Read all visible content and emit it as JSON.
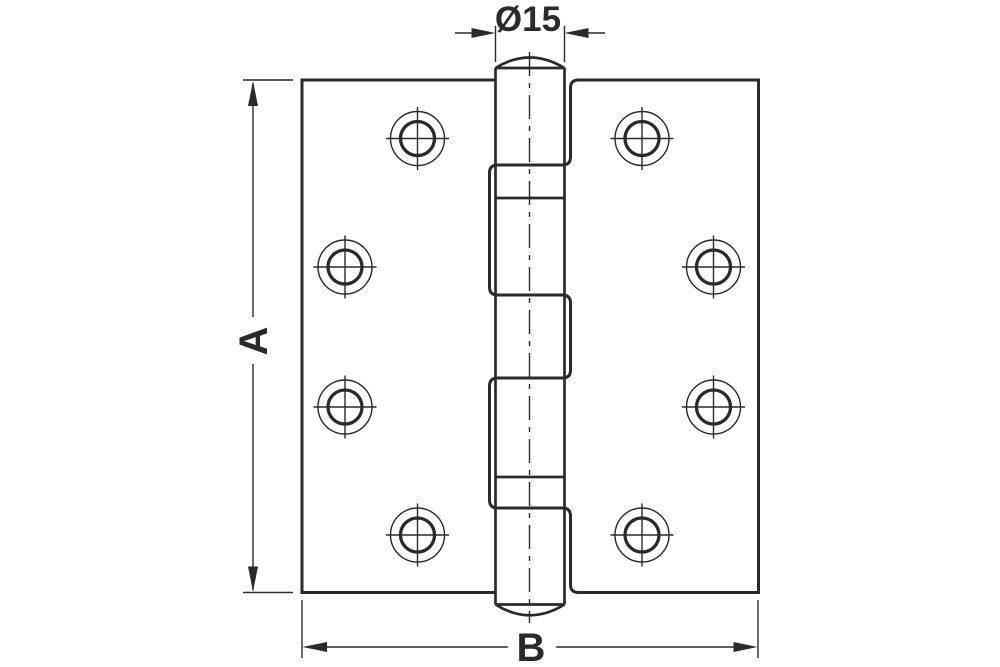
{
  "diagram": {
    "type": "technical-line-drawing",
    "subject": "butt hinge, flat front view with central pin barrel and five interleaved knuckles",
    "screw_hole_count": 8
  },
  "labels": {
    "pin_diameter": "Ø15",
    "height": "A",
    "width": "B"
  },
  "colors": {
    "ink": "#2a2a2a",
    "background": "#ffffff"
  },
  "geometry": {
    "canvas": {
      "w": 1000,
      "h": 667
    },
    "stroke": {
      "thick": 3,
      "medium": 2.7,
      "thin": 1.4,
      "bore": 3.3
    },
    "plate": {
      "left": 302,
      "right": 758.5,
      "top": 80,
      "bottom": 592.5
    },
    "barrel": {
      "left": 495.5,
      "right": 564.5,
      "cx": 529.5,
      "top_chord": 68,
      "top_dome_ctrl": 47,
      "bottom_chord": 604.5,
      "bottom_dome_ctrl": 626,
      "centerline_top": 52,
      "centerline_bottom": 623,
      "plain_joints": [
        198,
        477
      ],
      "centerline_dash": "24 7 5 7"
    },
    "zigzag": {
      "cut_left": 489.5,
      "cut_right": 570.5,
      "r": 8,
      "joints": [
        165,
        295,
        378,
        508
      ]
    },
    "holes": {
      "outer_r": 27,
      "inner_r": 17,
      "cross_half": 31.5,
      "centers": [
        [
          417.5,
          138.5
        ],
        [
          345,
          267
        ],
        [
          345,
          407
        ],
        [
          417.5,
          535
        ],
        [
          642,
          138.5
        ],
        [
          713.5,
          267
        ],
        [
          713.5,
          407
        ],
        [
          642,
          535
        ]
      ]
    },
    "dim_dia": {
      "y": 33,
      "ext_top": 26,
      "ext_bot": 62,
      "tail_l": 455,
      "tail_r": 605,
      "ah_len": 24,
      "ah_w": 5
    },
    "dim_a": {
      "x": 253,
      "tick_x1": 243,
      "tick_x2": 293,
      "gap1": 317,
      "gap2": 364,
      "ah_len": 25,
      "ah_w": 5
    },
    "dim_b": {
      "y": 647,
      "ext_y1": 600,
      "ext_y2": 658,
      "gap1": 508,
      "gap2": 556,
      "ah_len": 25,
      "ah_w": 5
    }
  }
}
